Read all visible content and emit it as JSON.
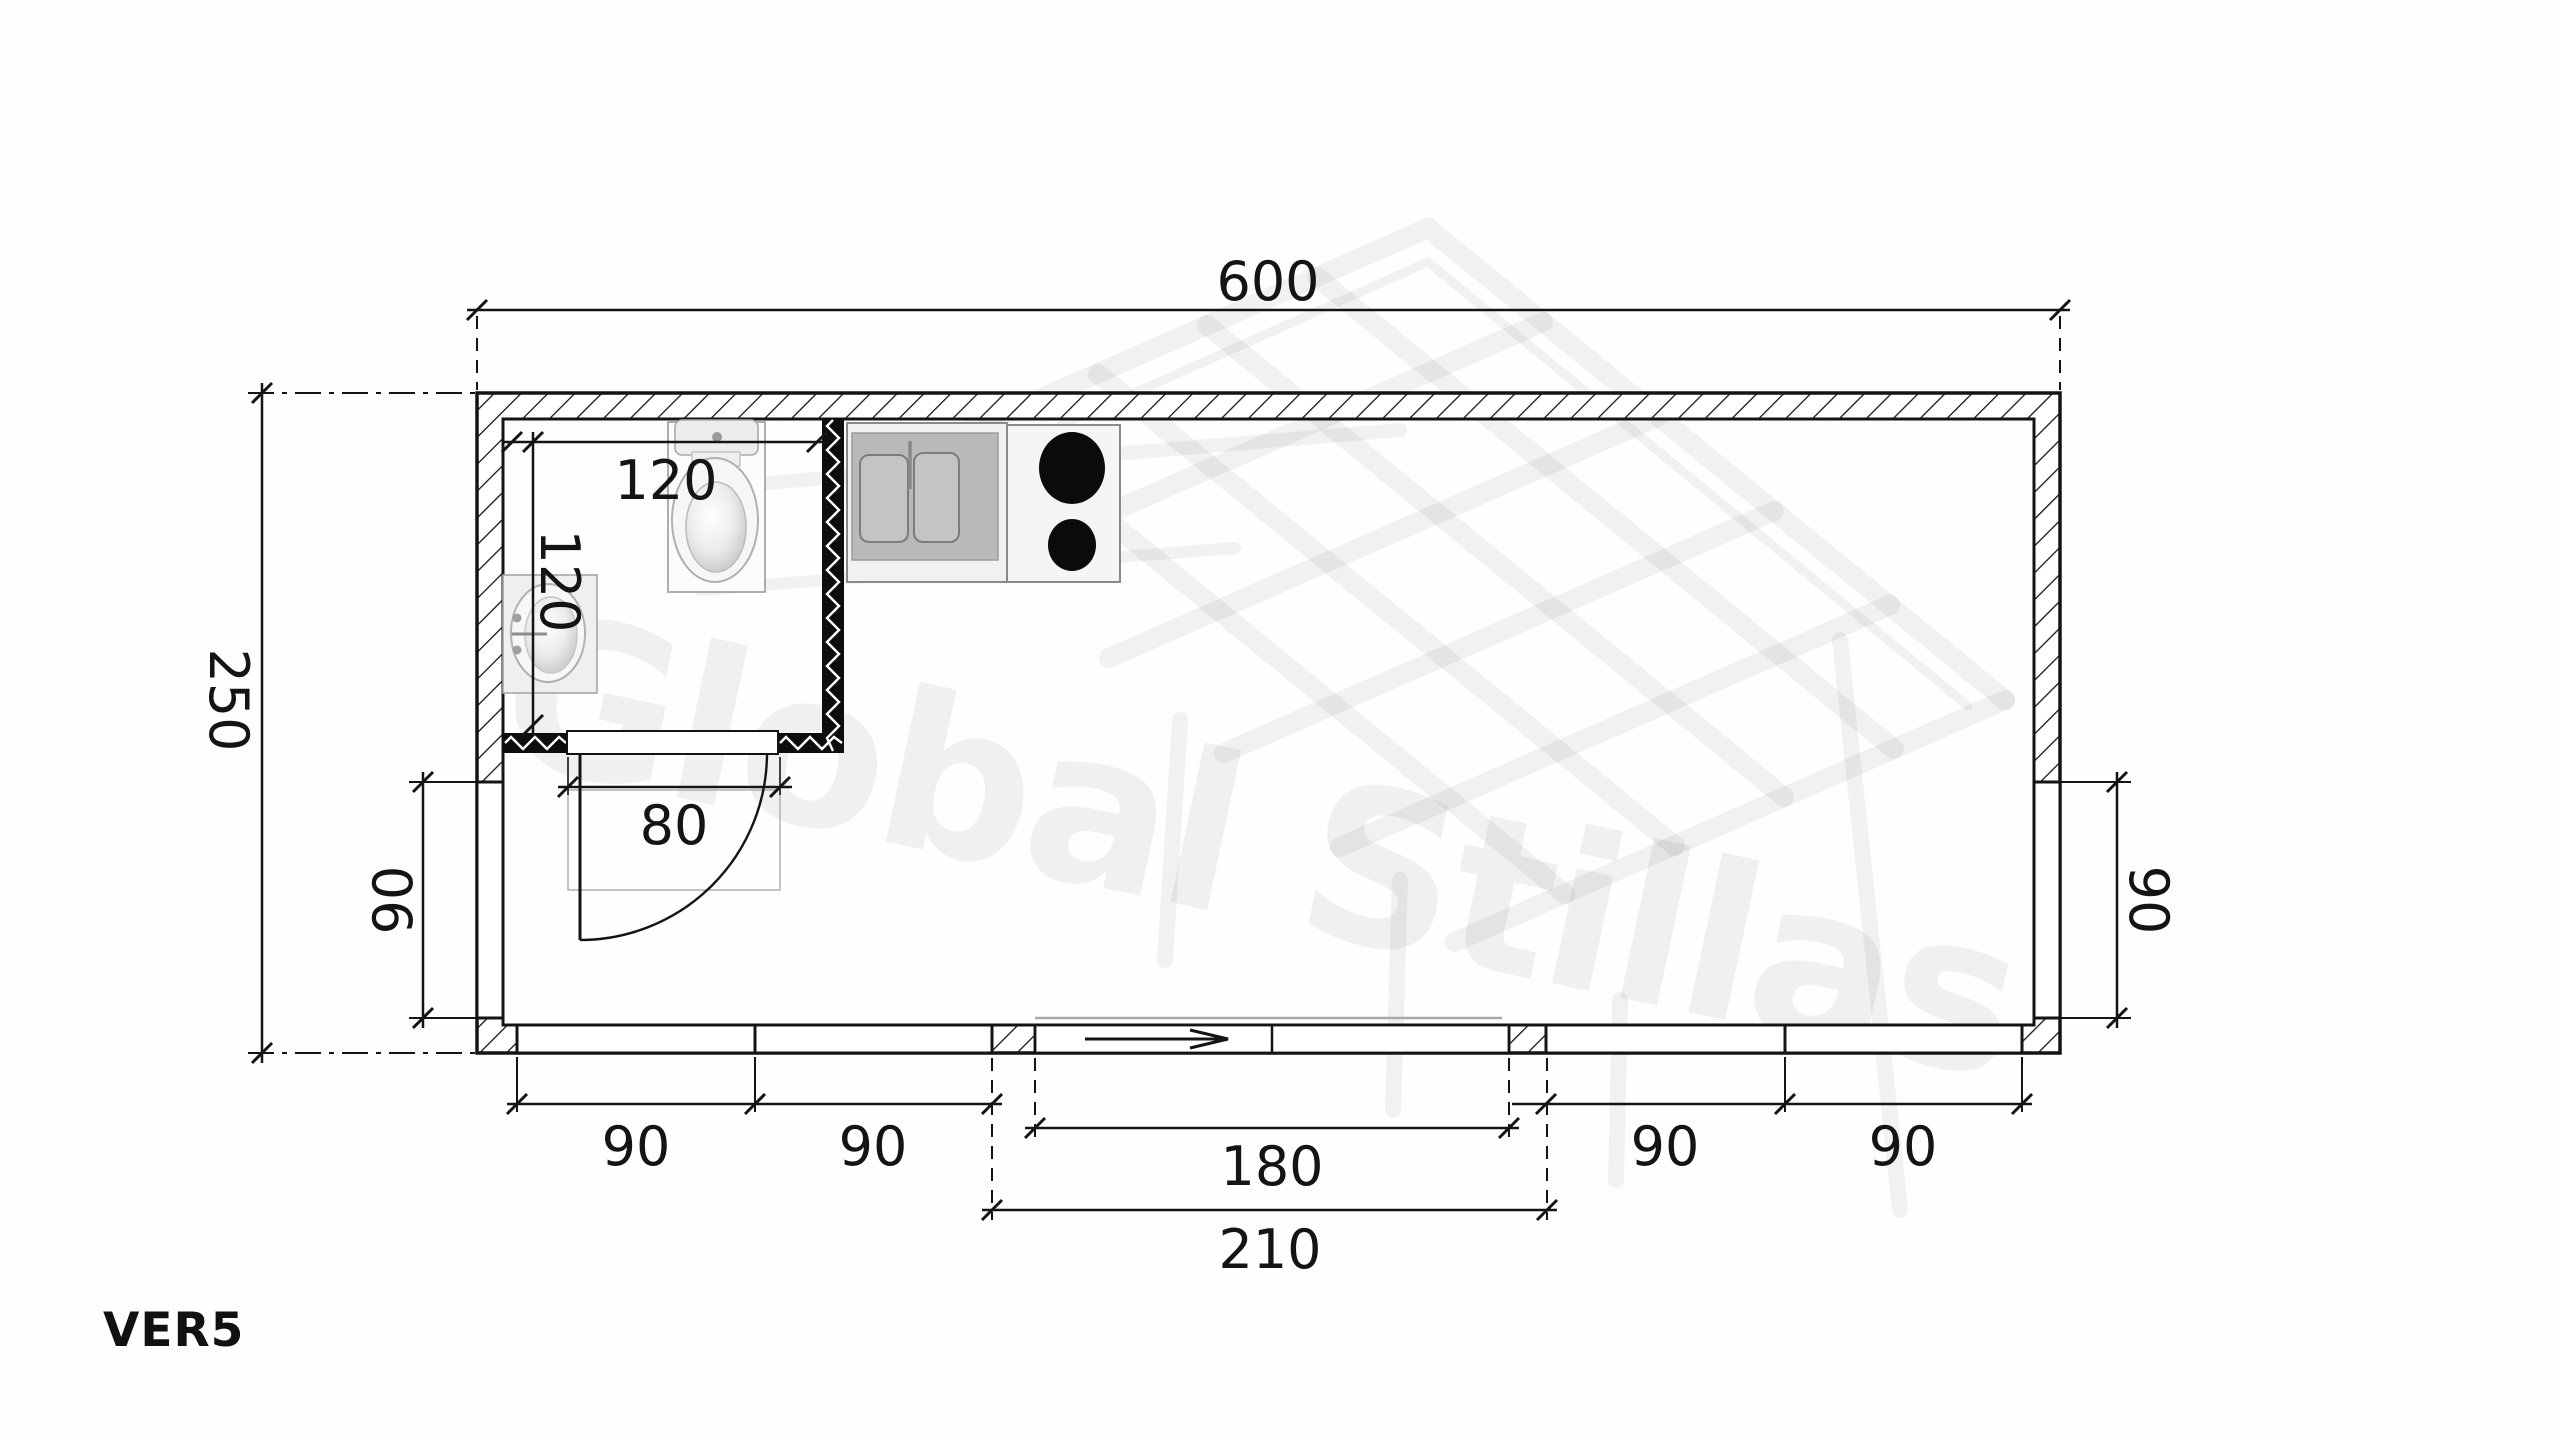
{
  "drawing": {
    "type": "floor-plan",
    "version_label": "VER5",
    "watermark_text": "Global Stillas"
  },
  "colors": {
    "ink": "#141414",
    "watermark": "rgba(0,0,0,0.05)",
    "fixture_light": "#efefef",
    "fixture_mid": "#b9b9b9",
    "burner_black": "#0b0b0b"
  },
  "fixtures": {
    "toilet": "toilet-top-view",
    "washbasin": "washbasin-top-view",
    "kitchen_sink": "double-bowl-kitchen-sink-top-view",
    "stove": "two-burner-stove-top-view"
  },
  "dimensions": {
    "overall_width": "600",
    "overall_depth": "250",
    "bathroom_width": "120",
    "bathroom_depth": "120",
    "bathroom_door": "80",
    "left_window": "90",
    "right_window": "90",
    "bottom_left_window_a": "90",
    "bottom_left_window_b": "90",
    "entry_opening": "180",
    "entry_with_frame": "210",
    "bottom_right_window_a": "90",
    "bottom_right_window_b": "90"
  }
}
